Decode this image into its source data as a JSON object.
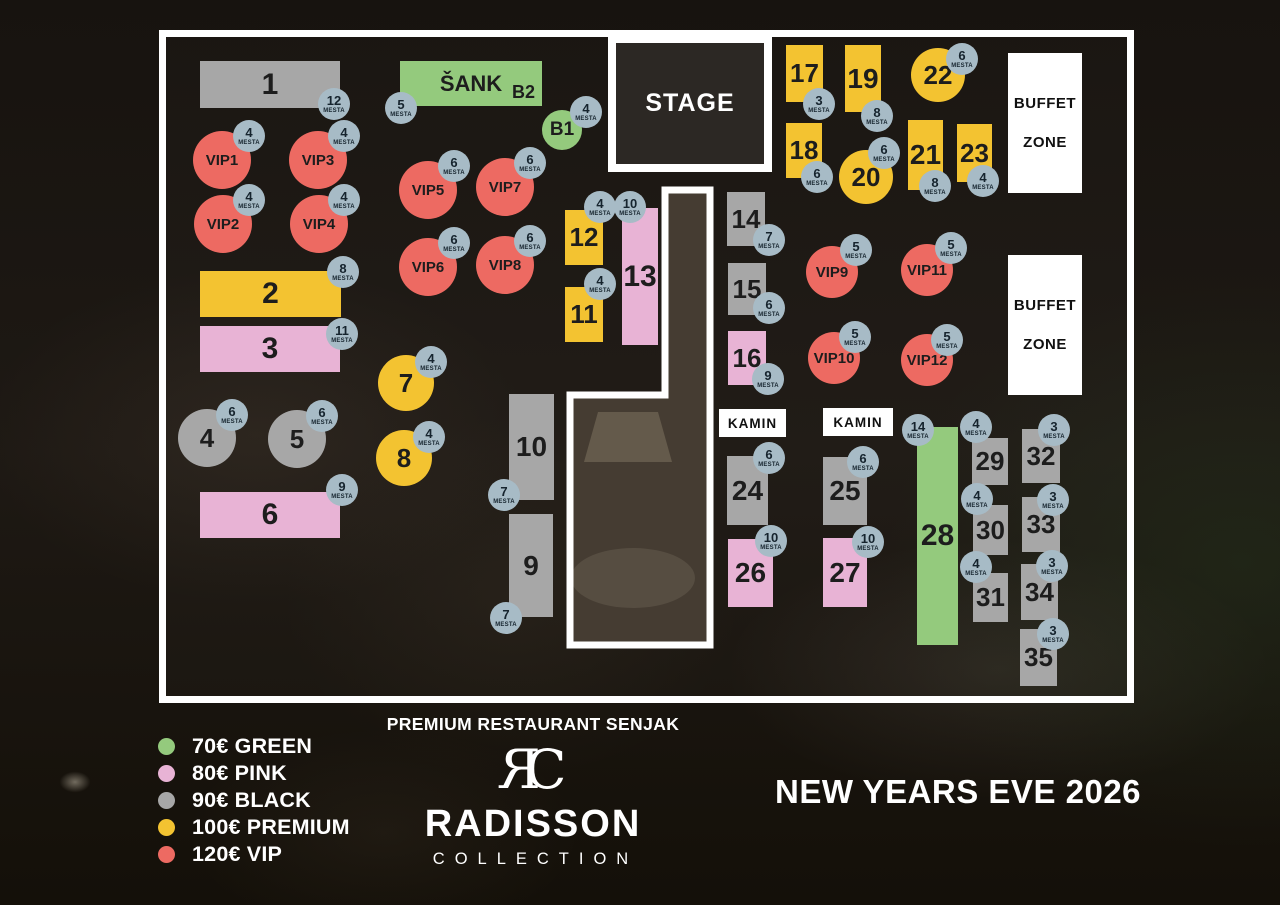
{
  "title": "NEW YEARS EVE 2026",
  "seat_unit": "MESTA",
  "branding": {
    "restaurant": "PREMIUM RESTAURANT SENJAK",
    "monogram": "RC",
    "brand": "RADISSON",
    "brand_sub": "COLLECTION"
  },
  "colors": {
    "green": "#94ca7d",
    "pink": "#e8b3d5",
    "gray": "#a7a7a7",
    "yellow": "#f3c331",
    "red": "#ed6a62",
    "badge": "#a7bbc6",
    "stage_fill": "#2c2824",
    "wall": "#ffffff"
  },
  "legend": [
    {
      "tier": "green",
      "label": "70€ GREEN"
    },
    {
      "tier": "pink",
      "label": "80€ PINK"
    },
    {
      "tier": "gray",
      "label": "90€ BLACK"
    },
    {
      "tier": "yellow",
      "label": "100€ PREMIUM"
    },
    {
      "tier": "red",
      "label": "120€ VIP"
    }
  ],
  "floor": {
    "x": 159,
    "y": 30,
    "w": 975,
    "h": 673
  },
  "corridor": {
    "points": "665,190 710,190 710,645 570,645 570,395 665,395"
  },
  "zones": [
    {
      "name": "stage",
      "type": "stage",
      "label": "STAGE",
      "x": 608,
      "y": 35,
      "w": 164,
      "h": 137
    },
    {
      "name": "buffet-zone-1",
      "type": "buffet",
      "lines": [
        "BUFFET",
        "ZONE"
      ],
      "x": 1008,
      "y": 53,
      "w": 74,
      "h": 140
    },
    {
      "name": "buffet-zone-2",
      "type": "buffet",
      "lines": [
        "BUFFET",
        "ZONE"
      ],
      "x": 1008,
      "y": 255,
      "w": 74,
      "h": 140
    },
    {
      "name": "kamin-1",
      "type": "kamin",
      "label": "KAMIN",
      "x": 719,
      "y": 409,
      "w": 67,
      "h": 28
    },
    {
      "name": "kamin-2",
      "type": "kamin",
      "label": "KAMIN",
      "x": 823,
      "y": 408,
      "w": 70,
      "h": 28
    }
  ],
  "tables": [
    {
      "id": "1",
      "label": "1",
      "tier": "gray",
      "shape": "rect",
      "x": 200,
      "y": 61,
      "w": 140,
      "h": 47,
      "seats": 12,
      "bx": 334,
      "by": 104
    },
    {
      "id": "sank-b2",
      "label": "ŠANK",
      "sub": "B2",
      "tier": "green",
      "shape": "rect",
      "x": 400,
      "y": 61,
      "w": 142,
      "h": 45,
      "seats": 5,
      "bx": 401,
      "by": 108
    },
    {
      "id": "b1",
      "label": "B1",
      "tier": "green",
      "shape": "circle",
      "cx": 562,
      "cy": 130,
      "r": 20,
      "seats": 4,
      "bx": 586,
      "by": 112
    },
    {
      "id": "vip1",
      "label": "VIP1",
      "tier": "red",
      "shape": "circle",
      "cx": 222,
      "cy": 160,
      "r": 29,
      "seats": 4,
      "bx": 249,
      "by": 136
    },
    {
      "id": "vip3",
      "label": "VIP3",
      "tier": "red",
      "shape": "circle",
      "cx": 318,
      "cy": 160,
      "r": 29,
      "seats": 4,
      "bx": 344,
      "by": 136
    },
    {
      "id": "vip2",
      "label": "VIP2",
      "tier": "red",
      "shape": "circle",
      "cx": 223,
      "cy": 224,
      "r": 29,
      "seats": 4,
      "bx": 249,
      "by": 200
    },
    {
      "id": "vip4",
      "label": "VIP4",
      "tier": "red",
      "shape": "circle",
      "cx": 319,
      "cy": 224,
      "r": 29,
      "seats": 4,
      "bx": 344,
      "by": 200
    },
    {
      "id": "vip5",
      "label": "VIP5",
      "tier": "red",
      "shape": "circle",
      "cx": 428,
      "cy": 190,
      "r": 29,
      "seats": 6,
      "bx": 454,
      "by": 166
    },
    {
      "id": "vip7",
      "label": "VIP7",
      "tier": "red",
      "shape": "circle",
      "cx": 505,
      "cy": 187,
      "r": 29,
      "seats": 6,
      "bx": 530,
      "by": 163
    },
    {
      "id": "vip6",
      "label": "VIP6",
      "tier": "red",
      "shape": "circle",
      "cx": 428,
      "cy": 267,
      "r": 29,
      "seats": 6,
      "bx": 454,
      "by": 243
    },
    {
      "id": "vip8",
      "label": "VIP8",
      "tier": "red",
      "shape": "circle",
      "cx": 505,
      "cy": 265,
      "r": 29,
      "seats": 6,
      "bx": 530,
      "by": 241
    },
    {
      "id": "2",
      "label": "2",
      "tier": "yellow",
      "shape": "rect",
      "x": 200,
      "y": 271,
      "w": 141,
      "h": 46,
      "seats": 8,
      "bx": 343,
      "by": 272
    },
    {
      "id": "3",
      "label": "3",
      "tier": "pink",
      "shape": "rect",
      "x": 200,
      "y": 326,
      "w": 140,
      "h": 46,
      "seats": 11,
      "bx": 342,
      "by": 334
    },
    {
      "id": "7",
      "label": "7",
      "tier": "yellow",
      "shape": "circle",
      "cx": 406,
      "cy": 383,
      "r": 28,
      "seats": 4,
      "bx": 431,
      "by": 362
    },
    {
      "id": "8",
      "label": "8",
      "tier": "yellow",
      "shape": "circle",
      "cx": 404,
      "cy": 458,
      "r": 28,
      "seats": 4,
      "bx": 429,
      "by": 437
    },
    {
      "id": "4",
      "label": "4",
      "tier": "gray",
      "shape": "circle",
      "cx": 207,
      "cy": 438,
      "r": 29,
      "seats": 6,
      "bx": 232,
      "by": 415
    },
    {
      "id": "5",
      "label": "5",
      "tier": "gray",
      "shape": "circle",
      "cx": 297,
      "cy": 439,
      "r": 29,
      "seats": 6,
      "bx": 322,
      "by": 416
    },
    {
      "id": "6",
      "label": "6",
      "tier": "pink",
      "shape": "rect",
      "x": 200,
      "y": 492,
      "w": 140,
      "h": 46,
      "seats": 9,
      "bx": 342,
      "by": 490
    },
    {
      "id": "10",
      "label": "10",
      "tier": "gray",
      "shape": "rect",
      "x": 509,
      "y": 394,
      "w": 45,
      "h": 106,
      "seats": 7,
      "bx": 504,
      "by": 495
    },
    {
      "id": "9",
      "label": "9",
      "tier": "gray",
      "shape": "rect",
      "x": 509,
      "y": 514,
      "w": 44,
      "h": 103,
      "seats": 7,
      "bx": 506,
      "by": 618
    },
    {
      "id": "12",
      "label": "12",
      "tier": "yellow",
      "shape": "rect",
      "x": 565,
      "y": 210,
      "w": 38,
      "h": 55,
      "seats": 4,
      "bx": 600,
      "by": 207
    },
    {
      "id": "11",
      "label": "11",
      "tier": "yellow",
      "shape": "rect",
      "x": 565,
      "y": 287,
      "w": 38,
      "h": 55,
      "seats": 4,
      "bx": 600,
      "by": 284
    },
    {
      "id": "13",
      "label": "13",
      "tier": "pink",
      "shape": "rect",
      "x": 622,
      "y": 208,
      "w": 36,
      "h": 137,
      "seats": 10,
      "bx": 630,
      "by": 207
    },
    {
      "id": "14",
      "label": "14",
      "tier": "gray",
      "shape": "rect",
      "x": 727,
      "y": 192,
      "w": 38,
      "h": 54,
      "seats": 7,
      "bx": 769,
      "by": 240
    },
    {
      "id": "15",
      "label": "15",
      "tier": "gray",
      "shape": "rect",
      "x": 728,
      "y": 263,
      "w": 38,
      "h": 52,
      "seats": 6,
      "bx": 769,
      "by": 308
    },
    {
      "id": "16",
      "label": "16",
      "tier": "pink",
      "shape": "rect",
      "x": 728,
      "y": 331,
      "w": 38,
      "h": 54,
      "seats": 9,
      "bx": 768,
      "by": 379
    },
    {
      "id": "17",
      "label": "17",
      "tier": "yellow",
      "shape": "rect",
      "x": 786,
      "y": 45,
      "w": 37,
      "h": 57,
      "seats": 3,
      "bx": 819,
      "by": 104
    },
    {
      "id": "19",
      "label": "19",
      "tier": "yellow",
      "shape": "rect",
      "x": 845,
      "y": 45,
      "w": 36,
      "h": 67,
      "seats": 8,
      "bx": 877,
      "by": 116
    },
    {
      "id": "22",
      "label": "22",
      "tier": "yellow",
      "shape": "circle",
      "cx": 938,
      "cy": 75,
      "r": 27,
      "seats": 6,
      "bx": 962,
      "by": 59
    },
    {
      "id": "18",
      "label": "18",
      "tier": "yellow",
      "shape": "rect",
      "x": 786,
      "y": 123,
      "w": 36,
      "h": 55,
      "seats": 6,
      "bx": 817,
      "by": 177
    },
    {
      "id": "20",
      "label": "20",
      "tier": "yellow",
      "shape": "circle",
      "cx": 866,
      "cy": 177,
      "r": 27,
      "seats": 6,
      "bx": 884,
      "by": 153
    },
    {
      "id": "21",
      "label": "21",
      "tier": "yellow",
      "shape": "rect",
      "x": 908,
      "y": 120,
      "w": 35,
      "h": 70,
      "seats": 8,
      "bx": 935,
      "by": 186
    },
    {
      "id": "23",
      "label": "23",
      "tier": "yellow",
      "shape": "rect",
      "x": 957,
      "y": 124,
      "w": 35,
      "h": 58,
      "seats": 4,
      "bx": 983,
      "by": 181
    },
    {
      "id": "vip9",
      "label": "VIP9",
      "tier": "red",
      "shape": "circle",
      "cx": 832,
      "cy": 272,
      "r": 26,
      "seats": 5,
      "bx": 856,
      "by": 250
    },
    {
      "id": "vip11",
      "label": "VIP11",
      "tier": "red",
      "shape": "circle",
      "cx": 927,
      "cy": 270,
      "r": 26,
      "seats": 5,
      "bx": 951,
      "by": 248
    },
    {
      "id": "vip10",
      "label": "VIP10",
      "tier": "red",
      "shape": "circle",
      "cx": 834,
      "cy": 358,
      "r": 26,
      "seats": 5,
      "bx": 855,
      "by": 337
    },
    {
      "id": "vip12",
      "label": "VIP12",
      "tier": "red",
      "shape": "circle",
      "cx": 927,
      "cy": 360,
      "r": 26,
      "seats": 5,
      "bx": 947,
      "by": 340
    },
    {
      "id": "24",
      "label": "24",
      "tier": "gray",
      "shape": "rect",
      "x": 727,
      "y": 456,
      "w": 41,
      "h": 69,
      "seats": 6,
      "bx": 769,
      "by": 458
    },
    {
      "id": "25",
      "label": "25",
      "tier": "gray",
      "shape": "rect",
      "x": 823,
      "y": 457,
      "w": 44,
      "h": 68,
      "seats": 6,
      "bx": 863,
      "by": 462
    },
    {
      "id": "26",
      "label": "26",
      "tier": "pink",
      "shape": "rect",
      "x": 728,
      "y": 539,
      "w": 45,
      "h": 68,
      "seats": 10,
      "bx": 771,
      "by": 541
    },
    {
      "id": "27",
      "label": "27",
      "tier": "pink",
      "shape": "rect",
      "x": 823,
      "y": 538,
      "w": 44,
      "h": 69,
      "seats": 10,
      "bx": 868,
      "by": 542
    },
    {
      "id": "28",
      "label": "28",
      "tier": "green",
      "shape": "rect",
      "x": 917,
      "y": 427,
      "w": 41,
      "h": 218,
      "seats": 14,
      "bx": 918,
      "by": 430
    },
    {
      "id": "29",
      "label": "29",
      "tier": "gray",
      "shape": "rect",
      "x": 972,
      "y": 438,
      "w": 36,
      "h": 47,
      "seats": 4,
      "bx": 976,
      "by": 427
    },
    {
      "id": "30",
      "label": "30",
      "tier": "gray",
      "shape": "rect",
      "x": 973,
      "y": 505,
      "w": 35,
      "h": 50,
      "seats": 4,
      "bx": 977,
      "by": 499
    },
    {
      "id": "31",
      "label": "31",
      "tier": "gray",
      "shape": "rect",
      "x": 973,
      "y": 573,
      "w": 35,
      "h": 49,
      "seats": 4,
      "bx": 976,
      "by": 567
    },
    {
      "id": "32",
      "label": "32",
      "tier": "gray",
      "shape": "rect",
      "x": 1022,
      "y": 429,
      "w": 38,
      "h": 54,
      "seats": 3,
      "bx": 1054,
      "by": 430
    },
    {
      "id": "33",
      "label": "33",
      "tier": "gray",
      "shape": "rect",
      "x": 1022,
      "y": 497,
      "w": 38,
      "h": 55,
      "seats": 3,
      "bx": 1053,
      "by": 500
    },
    {
      "id": "34",
      "label": "34",
      "tier": "gray",
      "shape": "rect",
      "x": 1021,
      "y": 564,
      "w": 37,
      "h": 56,
      "seats": 3,
      "bx": 1052,
      "by": 566
    },
    {
      "id": "35",
      "label": "35",
      "tier": "gray",
      "shape": "rect",
      "x": 1020,
      "y": 629,
      "w": 37,
      "h": 57,
      "seats": 3,
      "bx": 1053,
      "by": 634
    }
  ]
}
